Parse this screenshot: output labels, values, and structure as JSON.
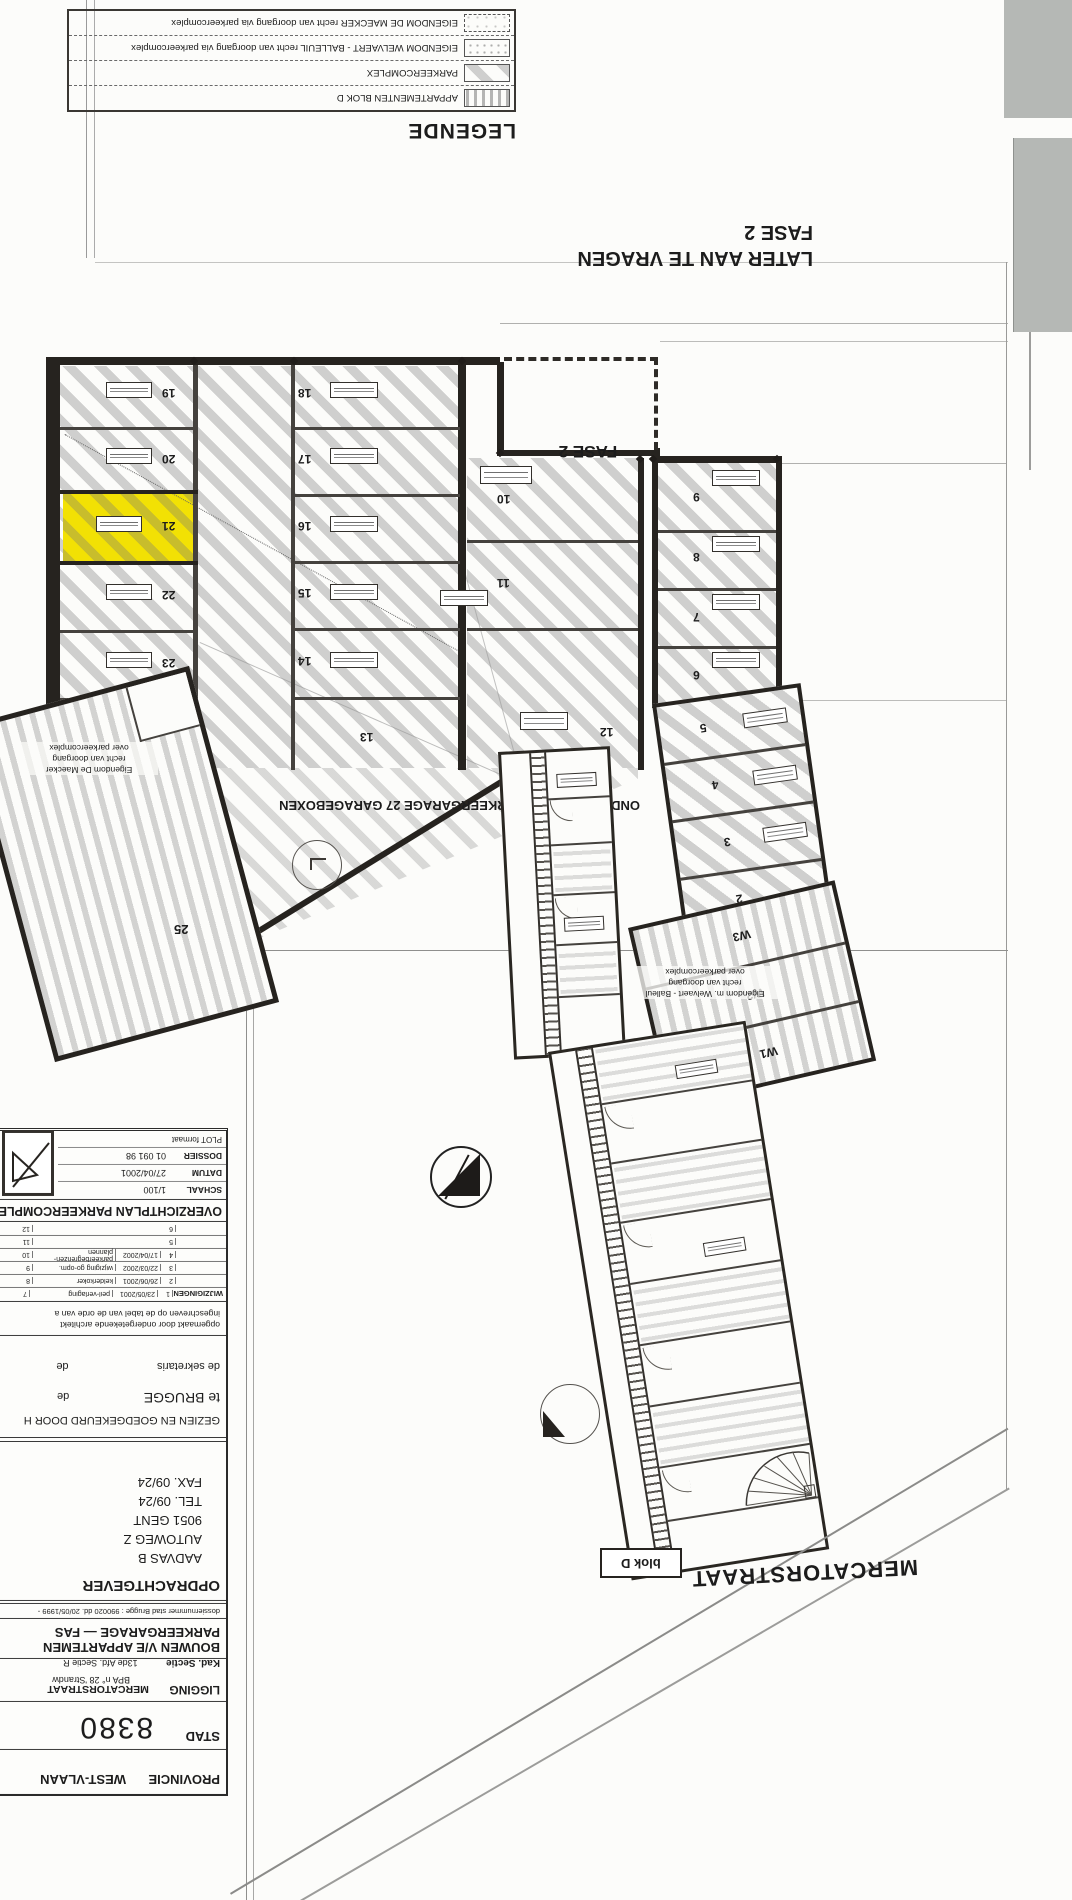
{
  "colors": {
    "highlight_yellow": "#f2e104",
    "paper": "#fcfcfa",
    "ink": "#26231f",
    "scan_gray": "#b5b8b5"
  },
  "legend": {
    "title": "LEGENDE",
    "rows": [
      {
        "label": "EIGENDOM DE MAECKER recht van doorgang via parkeercomplex",
        "pattern": "dashed-dots"
      },
      {
        "label": "EIGENDOM WELVAERT - BALLEUIL recht van doorgang via parkeercomplex",
        "pattern": "fine-stipple"
      },
      {
        "label": "PARKEERCOMPLEX",
        "pattern": "diagonal-hatch"
      },
      {
        "label": "APPARTEMENTEN BLOK D",
        "pattern": "vertical-stipple"
      }
    ]
  },
  "notes": {
    "later_line1": "LATER AAN TE VRAGEN",
    "later_line2": "FASE 2",
    "fase2_plan": "FASE 2",
    "central": "ONDERGRONDSE PARKEERGARAGE 27 GARAGEBOXEN",
    "eigendom_maecker": {
      "l1": "Eigendom De Maecker",
      "l2": "recht van doorgang",
      "l3": "over parkeercomplex"
    },
    "eigendom_welvaert": {
      "l1": "Eigendom m. Welvaert - Balleul",
      "l2": "recht van doorgang",
      "l3": "over parkeercomplex"
    },
    "blok_d": "blok D",
    "street": "MERCATORSTRAAT"
  },
  "plan": {
    "numbers": {
      "left": [
        "19",
        "20",
        "21",
        "22",
        "23",
        "24"
      ],
      "mid": [
        "18",
        "17",
        "16",
        "15",
        "14",
        "13"
      ],
      "col3": [
        "10",
        "11",
        "12"
      ],
      "right": [
        "9",
        "8",
        "7",
        "6"
      ],
      "lower": [
        "5",
        "4",
        "3",
        "2"
      ],
      "w": [
        "W3",
        "W2",
        "W1"
      ],
      "box25": "25"
    },
    "highlighted_box": "21"
  },
  "titleblock": {
    "provincie_label": "PROVINCIE",
    "provincie": "WEST-VLAAN",
    "stad_label": "STAD",
    "stad": "8380",
    "ligging_label": "LIGGING",
    "ligging": "MERCATORSTRAAT",
    "bpa": "BPA n° 28 'Strandw",
    "kad_label": "Kad. Sectie",
    "kad": "13de Afd. Sectie R",
    "project_line1": "BOUWEN V/E APPARTEMEN",
    "project_line2": "PARKEERGARAGE — FAS",
    "dossiernummer": "dossiernummer stad Brugge : 990020 dd. 20/05/1999 -",
    "opdrachtgever_label": "OPDRACHTGEVER",
    "opdr_line1": "AADVAS B",
    "opdr_line2": "AUTOWEG Z",
    "opdr_line3": "9051 GENT",
    "opdr_line4": "TEL. 09/24",
    "opdr_line5": "FAX. 09/24",
    "gezien": "GEZIEN EN GOEDGEKEURD DOOR H",
    "te_brugge": "te BRUGGE",
    "de1": "de",
    "sekretaris": "de sekretaris",
    "de2": "de",
    "note_line1": "opgemaakt door ondergetekende architekt",
    "note_line2": "ingeschreven op de tabel van de orde van a",
    "wijzigingen_label": "WIJZIGINGEN",
    "rev_rows": [
      {
        "n": "1",
        "date": "23/05/2001",
        "desc": "peil-verlaging",
        "n2": "7"
      },
      {
        "n": "2",
        "date": "26/06/2001",
        "desc": "kelderkoker",
        "n2": "8"
      },
      {
        "n": "3",
        "date": "22/03/2002",
        "desc": "wijziging go-opm.",
        "n2": "9"
      },
      {
        "n": "4",
        "date": "17/04/2002",
        "desc": "parkeerbegrenzen-plannen",
        "n2": "10"
      },
      {
        "n": "5",
        "date": "",
        "desc": "",
        "n2": "11"
      },
      {
        "n": "6",
        "date": "",
        "desc": "",
        "n2": "12"
      }
    ],
    "header": "OVERZICHTPLAN PARKEERCOMPLEX",
    "schaal_label": "SCHAAL",
    "schaal": "1/100",
    "datum_label": "DATUM",
    "datum": "27/04/2001",
    "dossier_label": "DOSSIER",
    "dossier": "01 091 98",
    "plot_label": "PLOT formaat"
  }
}
